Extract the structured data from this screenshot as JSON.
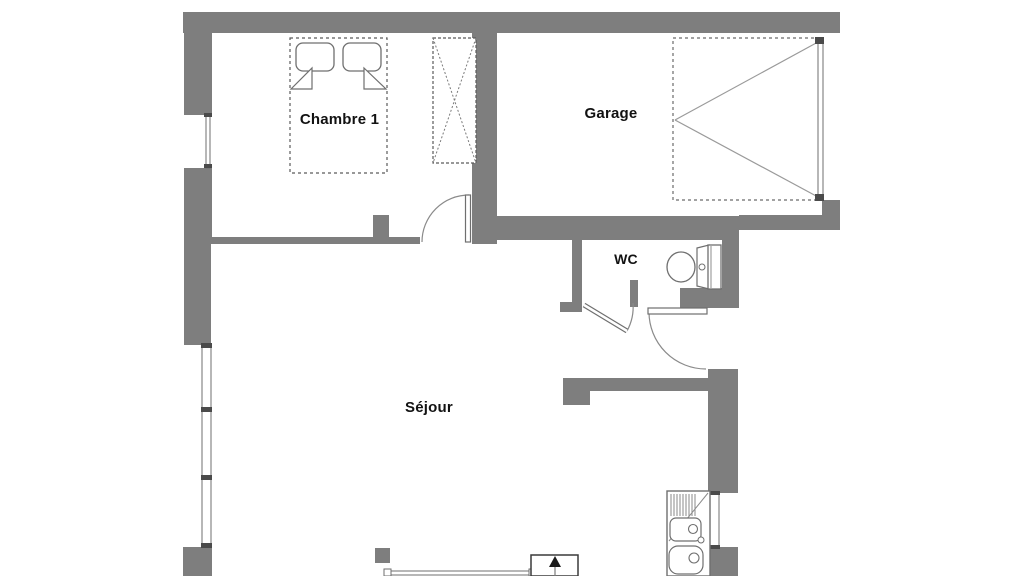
{
  "floorplan": {
    "rooms": [
      {
        "id": "chambre-1",
        "label": "Chambre 1"
      },
      {
        "id": "garage",
        "label": "Garage"
      },
      {
        "id": "wc",
        "label": "WC"
      },
      {
        "id": "sejour",
        "label": "Séjour"
      }
    ],
    "fixtures": [
      "double-bed",
      "wardrobe",
      "garage-door",
      "bedroom-swing-door",
      "wc-swing-door",
      "entry-swing-door",
      "toilet",
      "kitchen-sink",
      "staircase-up-arrow",
      "bedroom-window",
      "living-room-window",
      "kitchen-window",
      "bottom-bay-window"
    ],
    "colors": {
      "wall": "#7e7e7e",
      "line": "#6f6f6f",
      "dark": "#4a4a4a",
      "text": "#121212",
      "bg": "#ffffff"
    }
  }
}
